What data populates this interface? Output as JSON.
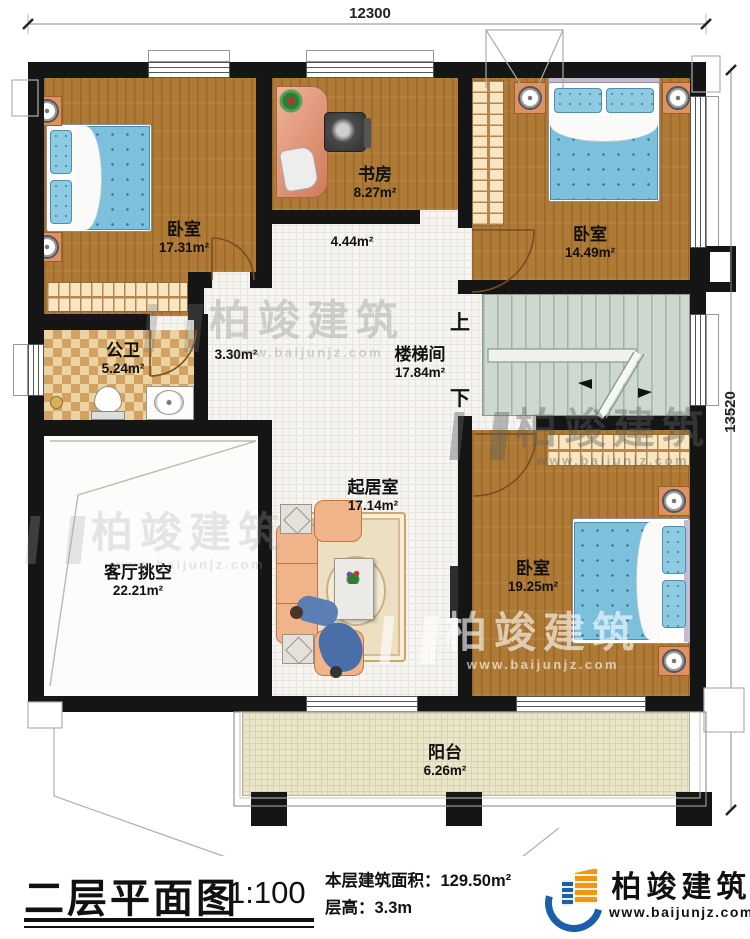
{
  "dims": {
    "top": "12300",
    "right": "13520"
  },
  "rooms": {
    "bedroom1": {
      "name": "卧室",
      "area": "17.31m²"
    },
    "study": {
      "name": "书房",
      "area": "8.27m²"
    },
    "bedroom2": {
      "name": "卧室",
      "area": "14.49m²"
    },
    "bathroom": {
      "name": "公卫",
      "area": "5.24m²"
    },
    "hall": {
      "area": "4.44m²"
    },
    "corridor": {
      "area": "3.30m²"
    },
    "stairwell": {
      "name": "楼梯间",
      "area": "17.84m²"
    },
    "living_void": {
      "name": "客厅挑空",
      "area": "22.21m²"
    },
    "family_room": {
      "name": "起居室",
      "area": "17.14m²"
    },
    "bedroom3": {
      "name": "卧室",
      "area": "19.25m²"
    },
    "balcony": {
      "name": "阳台",
      "area": "6.26m²"
    }
  },
  "stairs": {
    "up": "上",
    "down": "下"
  },
  "watermark": {
    "brand": "柏竣建筑",
    "url": "www.baijunjz.com"
  },
  "footer": {
    "title": "二层平面图",
    "scale": "1:100",
    "area_line": "本层建筑面积：129.50m²",
    "height_line": "层高：3.3m",
    "brand": "柏竣建筑",
    "url": "www.baijunjz.com"
  },
  "colors": {
    "wall": "#151515",
    "wood_floor": "#ae7a35",
    "bed_blue": "#7cc0dc",
    "brand_blue": "#1a5fa8",
    "brand_orange": "#f5960f"
  }
}
